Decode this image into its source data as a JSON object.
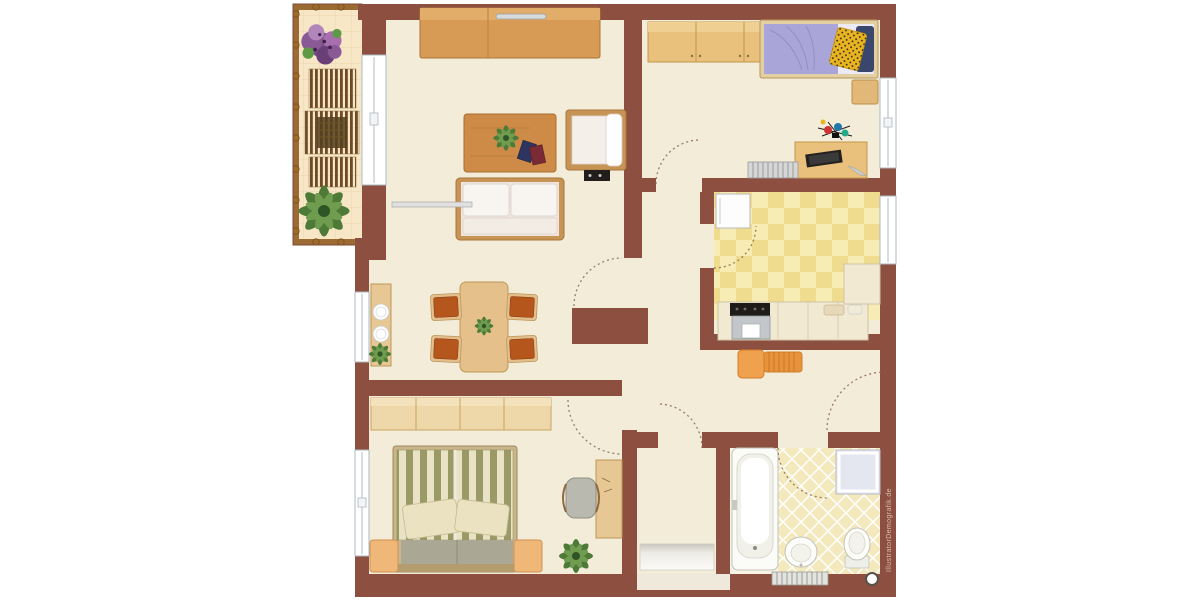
{
  "watermark": {
    "text": "IllustratorDemografik.de"
  },
  "palette": {
    "wall": "#8d4f3f",
    "floor": "#f3ecd9",
    "balcony_tile": "#f7e7c6",
    "kitchen_tile": "#f6ecb4",
    "bath_tile": "#f3e9bc",
    "wood_mid": "#d79b55",
    "wood_light": "#e9c17c",
    "accent_orange": "#e8933c",
    "bed_lavender": "#a9a5d8",
    "pillow_yellow": "#e9b421",
    "pillow_navy": "#3a466b",
    "duvet_stripe_olive": "#9a9a66",
    "chair_rust": "#b5571c",
    "plant_green": "#5b8a3c",
    "flower_purple": "#8a5a96"
  },
  "floorplan": {
    "type": "apartment-floor-plan",
    "window_count": 5,
    "door_swing_count": 7,
    "rooms": [
      {
        "name": "balcony",
        "furniture": [
          "flower-box",
          "patio-furniture-set",
          "potted-plant"
        ]
      },
      {
        "name": "living-room",
        "furniture": [
          "sideboard",
          "coffee-table",
          "armchair",
          "stereo",
          "sofa",
          "radiator"
        ]
      },
      {
        "name": "children-room",
        "furniture": [
          "wardrobe",
          "single-bed",
          "side-unit",
          "toys",
          "desk-with-laptop",
          "radiator"
        ]
      },
      {
        "name": "kitchen",
        "furniture": [
          "fridge",
          "stove-with-oven",
          "counter",
          "counter-items"
        ]
      },
      {
        "name": "dining-area",
        "furniture": [
          "serving-table",
          "dining-table",
          "four-chairs",
          "potted-plant"
        ]
      },
      {
        "name": "bedroom",
        "furniture": [
          "wardrobe-sideboard",
          "double-bed",
          "two-nightstands",
          "desk",
          "desk-chair",
          "potted-plant"
        ]
      },
      {
        "name": "hallway",
        "furniture": [
          "coat-bench"
        ]
      },
      {
        "name": "entrance-vestibule",
        "furniture": [
          "doormat"
        ]
      },
      {
        "name": "bathroom",
        "furniture": [
          "bathtub",
          "shower",
          "washbasin",
          "toilet",
          "radiator",
          "door-stopper"
        ]
      }
    ]
  }
}
